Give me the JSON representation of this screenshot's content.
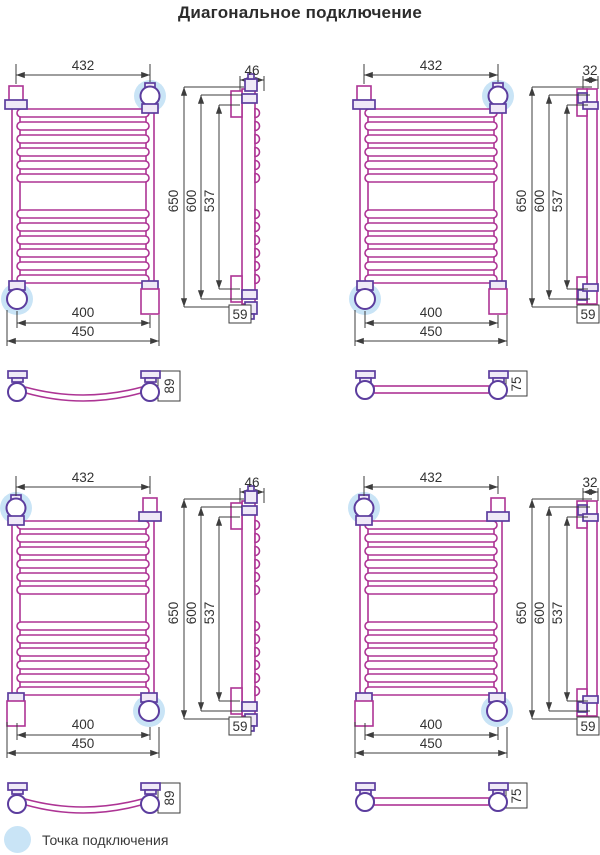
{
  "title": "Диагональное подключение",
  "legend": {
    "label": "Точка подключения"
  },
  "colors": {
    "pipe_outline": "#ad3494",
    "fitting_outline": "#5c3d9e",
    "fitting_fill": "#efe9f7",
    "connection_highlight": "#c9e4f6",
    "dimension_lines": "#3d3d3d",
    "text": "#333333"
  },
  "drawing": {
    "rung_groups": 2,
    "rungs_per_group": 6
  },
  "quadrants": [
    {
      "position": "top-left",
      "front": {
        "top_width": "432",
        "inner_width": "400",
        "outer_width": "450"
      },
      "side": {
        "top_depth": "46",
        "overall_height": "650",
        "mount_height": "600",
        "inner_height": "537",
        "bottom_depth": "59",
        "profile": "curved-rungs"
      },
      "bottom_view": {
        "depth": "89",
        "tube": "curved"
      },
      "connection_points": [
        "top-right",
        "bottom-left"
      ]
    },
    {
      "position": "top-right",
      "front": {
        "top_width": "432",
        "inner_width": "400",
        "outer_width": "450"
      },
      "side": {
        "top_depth": "32",
        "overall_height": "650",
        "mount_height": "600",
        "inner_height": "537",
        "bottom_depth": "59",
        "profile": "straight-rungs"
      },
      "bottom_view": {
        "depth": "75",
        "tube": "straight"
      },
      "connection_points": [
        "top-right",
        "bottom-left"
      ]
    },
    {
      "position": "bottom-left",
      "front": {
        "top_width": "432",
        "inner_width": "400",
        "outer_width": "450"
      },
      "side": {
        "top_depth": "46",
        "overall_height": "650",
        "mount_height": "600",
        "inner_height": "537",
        "bottom_depth": "59",
        "profile": "curved-rungs"
      },
      "bottom_view": {
        "depth": "89",
        "tube": "curved"
      },
      "connection_points": [
        "top-left",
        "bottom-right"
      ]
    },
    {
      "position": "bottom-right",
      "front": {
        "top_width": "432",
        "inner_width": "400",
        "outer_width": "450"
      },
      "side": {
        "top_depth": "32",
        "overall_height": "650",
        "mount_height": "600",
        "inner_height": "537",
        "bottom_depth": "59",
        "profile": "straight-rungs"
      },
      "bottom_view": {
        "depth": "75",
        "tube": "straight"
      },
      "connection_points": [
        "top-left",
        "bottom-right"
      ]
    }
  ]
}
